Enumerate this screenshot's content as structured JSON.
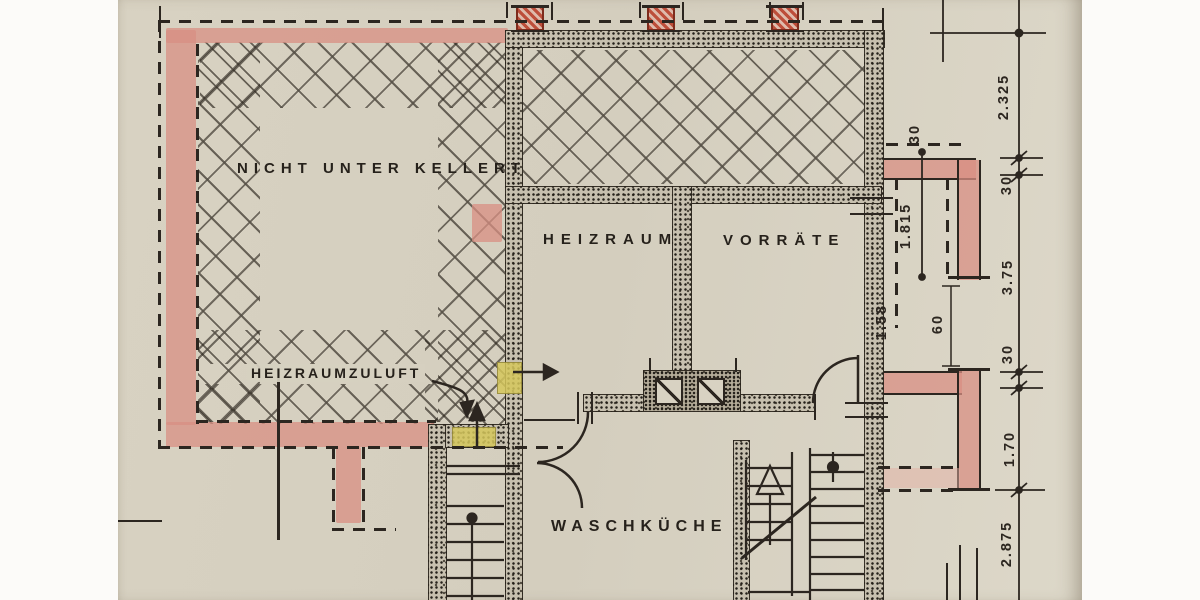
{
  "plan": {
    "rooms": [
      {
        "id": "nicht-unterkellert",
        "label": "NICHT UNTER KELLERT"
      },
      {
        "id": "heizraum",
        "label": "HEIZRAUM"
      },
      {
        "id": "vorraete",
        "label": "VORRÄTE"
      },
      {
        "id": "waschkueche",
        "label": "WASCHKÜCHE"
      }
    ],
    "annotations": [
      {
        "id": "heizraumzuluft",
        "label": "HEIZRAUMZULUFT"
      }
    ],
    "dimensions": {
      "right_chain": [
        "2.325",
        "30",
        "3.75",
        "30",
        "1.70",
        "2.875"
      ],
      "inner": [
        "1.815",
        "1.58",
        "60",
        "30"
      ]
    },
    "colors": {
      "paper": "#d7d1c1",
      "ink": "#2c2620",
      "highlight_pink": "#dfa89d",
      "highlight_pink_light": "#eccdc4",
      "highlight_yellow": "#d8ca67",
      "column_red": "#b03a28"
    }
  }
}
